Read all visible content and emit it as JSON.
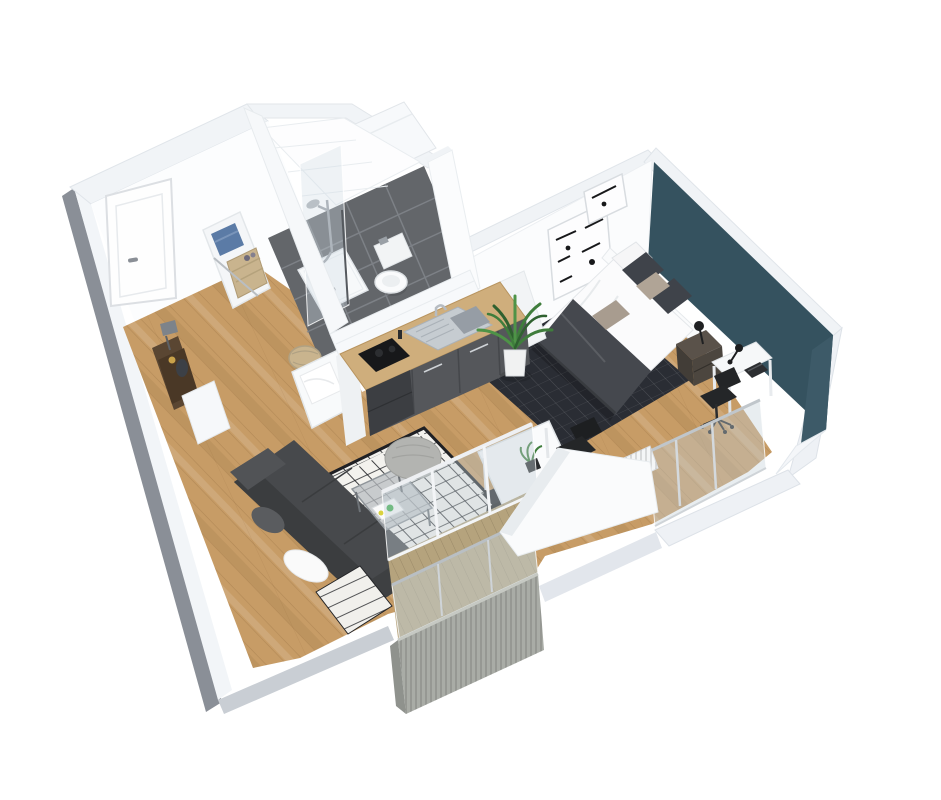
{
  "scene": {
    "type": "3d-floor-plan-render",
    "description": "Axonometric 3D render of a small studio apartment floor plan on a white background",
    "background": "#ffffff"
  },
  "palette": {
    "wall_white": "#fbfcfd",
    "wall_top_band": "#f0f3f6",
    "wall_shade": "#e4e9ee",
    "wall_outer_grey": "#c9ced4",
    "wall_dark_edge": "#8a8f97",
    "accent_wall_teal": "#35525f",
    "wood_floor": "#c79c66",
    "tile_floor": "#63666a",
    "tile_grout": "#82868c",
    "bedroom_rug": "#2a2d34",
    "living_rug_base": "#f3f2ee",
    "living_rug_pattern": "#1f2024",
    "sofa_grey": "#47494c",
    "sofa_back_grey": "#3b3d3f",
    "kitchen_cabinet": "#55575b",
    "kitchen_appliance": "#3c3e42",
    "counter_wood": "#cfae7c",
    "cooktop_black": "#17181a",
    "steel": "#c6ccd1",
    "chair_black": "#242628",
    "desk_white": "#f6f8f9",
    "bed_duvet": "#fbfbfc",
    "bed_throw": "#45484e",
    "pillow_dark": "#3f434a",
    "pillow_beige": "#b0a496",
    "headboard_white": "#fafbfc",
    "nightstand_brown": "#5a524a",
    "plant_green": "#3f7d3c",
    "plant_green_dark": "#2f6130",
    "pot_white": "#f1f2f2",
    "deck_wood": "#b5a37d",
    "cladding_grey": "#a9aca6",
    "glass_blue": "#c3d0d8",
    "toilet_white": "#fafbfc",
    "towel_blue": "#5b7ba6",
    "basket_tan": "#c9b48e",
    "console_walnut": "#5a4632",
    "pouf_grey": "#b3b4b1"
  },
  "rooms": [
    {
      "name": "entrance-hall",
      "floor": "wood",
      "furniture": [
        "entrance-door",
        "console-table",
        "table-lamp",
        "decor-vase",
        "shoe-cabinet"
      ]
    },
    {
      "name": "bathroom",
      "floor": "grey-tile",
      "furniture": [
        "walk-in-shower",
        "shower-glass",
        "wall-hung-toilet",
        "vanity-unit",
        "laundry-shelf",
        "towels",
        "laundry-basket",
        "woven-basket"
      ]
    },
    {
      "name": "kitchen",
      "floor": "wood",
      "furniture": [
        "kitchen-counter",
        "stainless-sink",
        "faucet",
        "cooktop",
        "base-cabinets",
        "appliance-block"
      ]
    },
    {
      "name": "living-room",
      "floor": "wood",
      "furniture": [
        "sofa",
        "white-cushion",
        "berber-rug",
        "glass-coffee-table",
        "magazines",
        "knitted-pouf"
      ]
    },
    {
      "name": "dining-area",
      "floor": "wood",
      "furniture": [
        "dining-table",
        "dining-chair",
        "dining-chair",
        "table-plant"
      ]
    },
    {
      "name": "bedroom",
      "floor": "wood-with-rug",
      "furniture": [
        "double-bed",
        "headboard",
        "pillows",
        "dark-rug",
        "nightstand",
        "bedside-lamp",
        "desk",
        "desk-lamp",
        "laptop",
        "office-chair",
        "wall-frame",
        "wall-frame",
        "radiator",
        "french-window"
      ]
    },
    {
      "name": "balcony",
      "floor": "deck",
      "furniture": [
        "glass-balustrade",
        "ribbed-cladding",
        "sliding-glass-door"
      ]
    },
    {
      "name": "circulation",
      "floor": "wood",
      "furniture": [
        "potted-palm"
      ]
    }
  ]
}
